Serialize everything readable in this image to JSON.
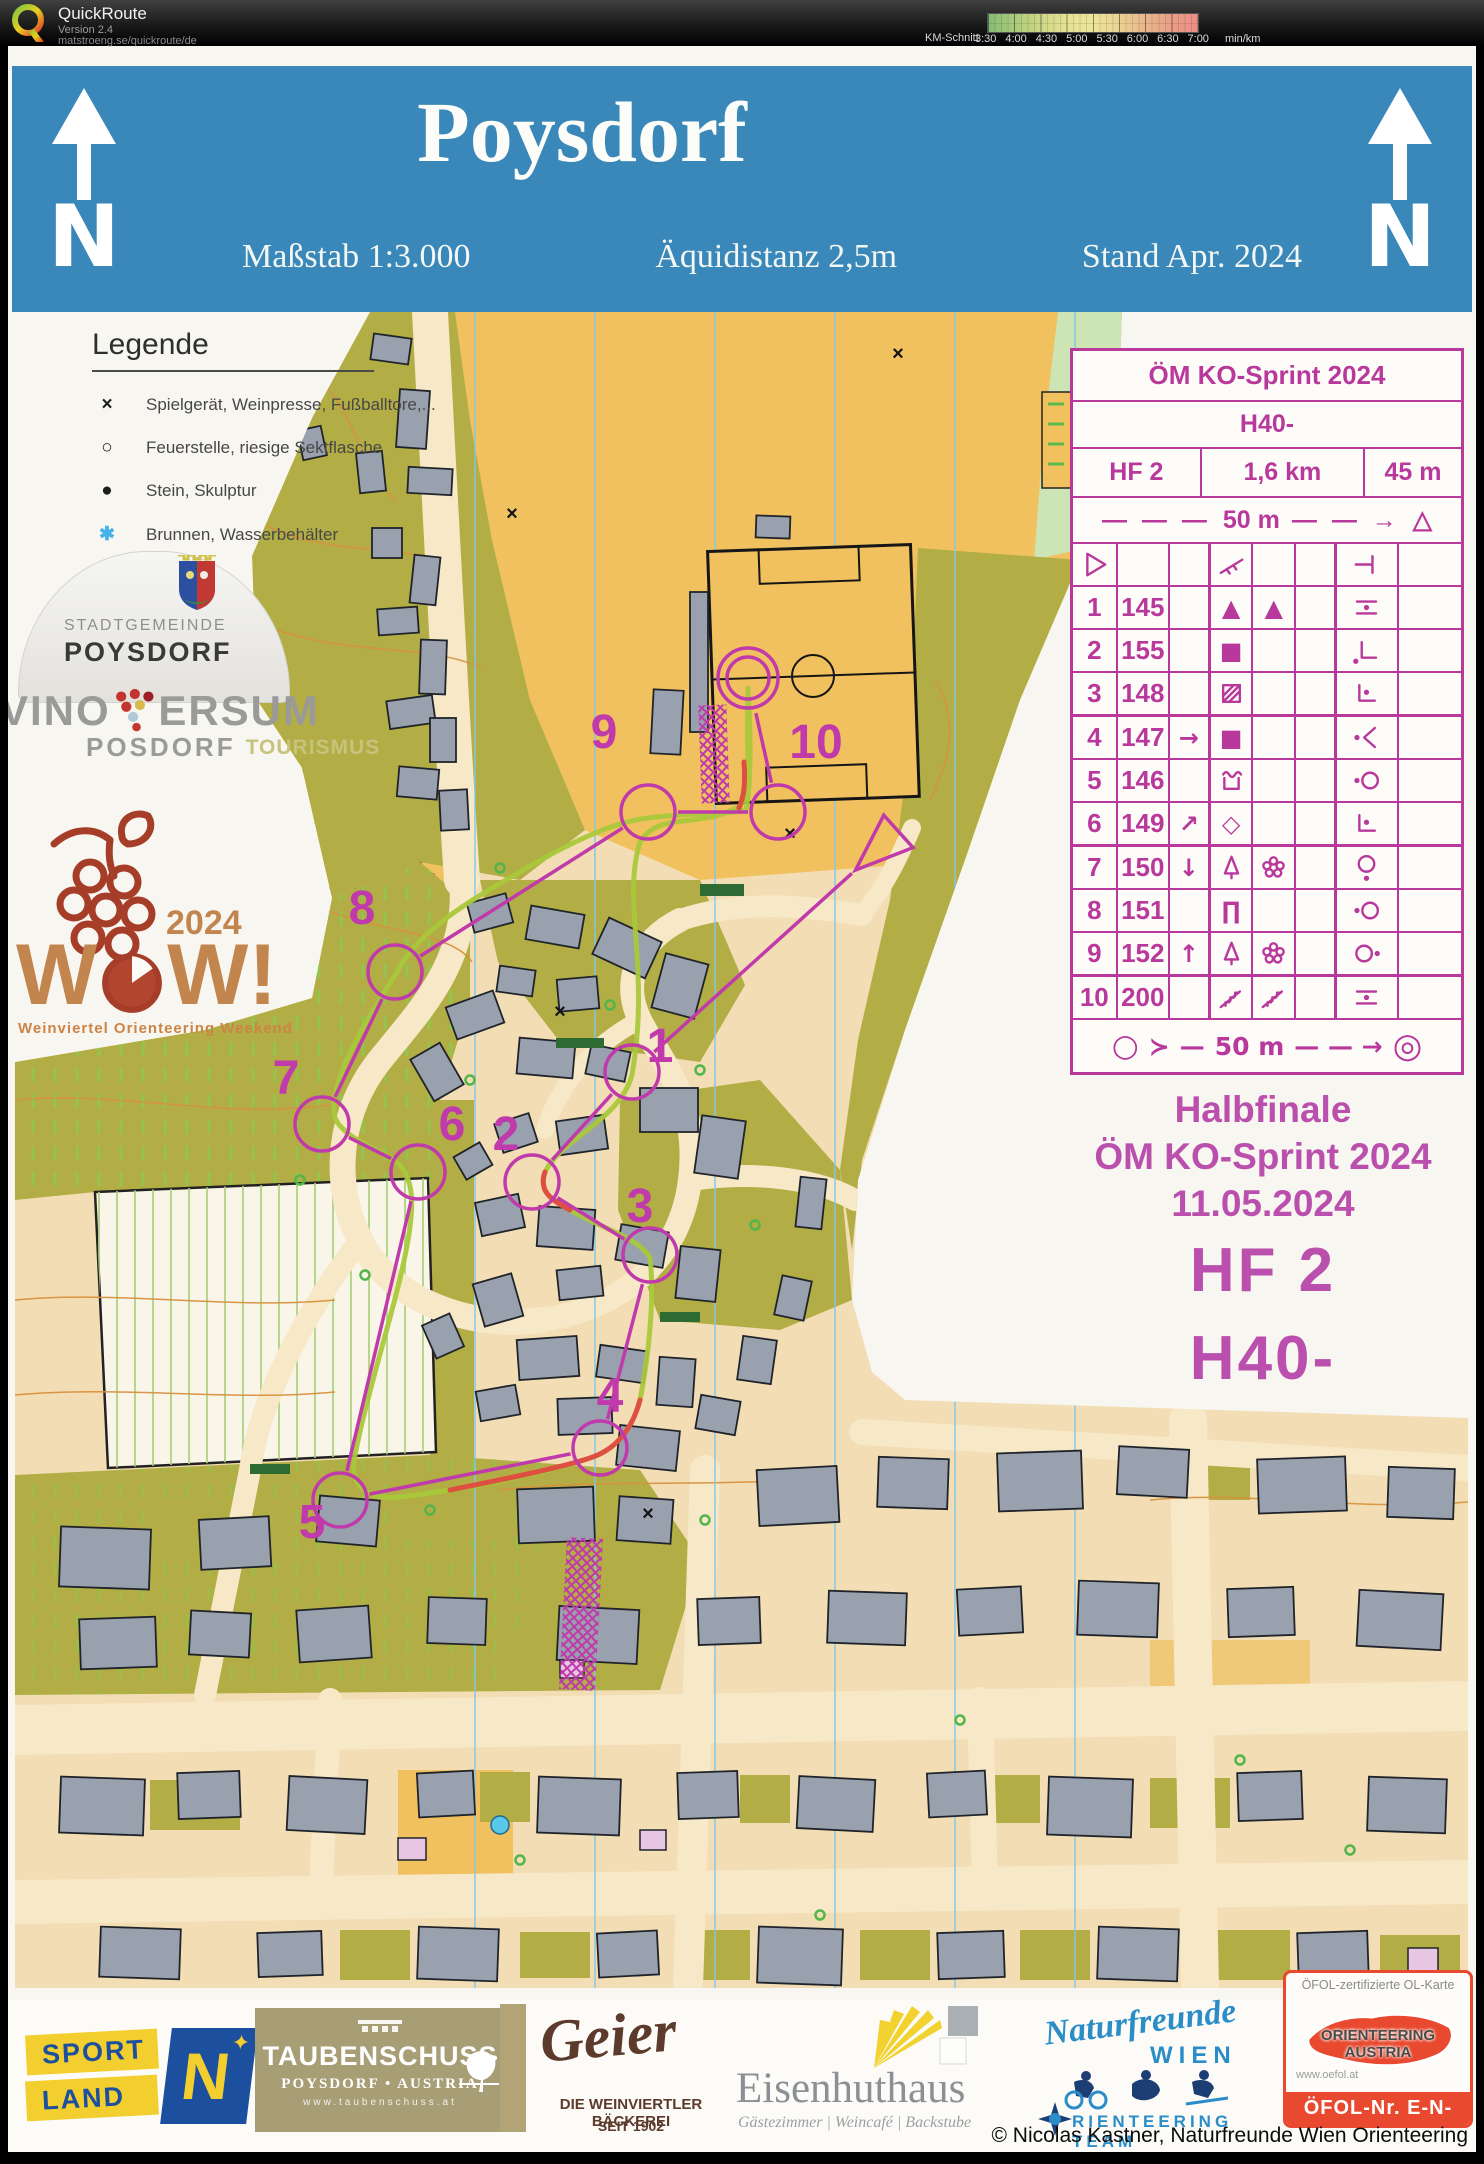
{
  "app": {
    "name": "QuickRoute",
    "version": "Version 2.4",
    "url": "matstroeng.se/quickroute/de"
  },
  "pace_scale": {
    "label": "KM-Schnitt",
    "unit": "min/km",
    "ticks": [
      "3:30",
      "4:00",
      "4:30",
      "5:00",
      "5:30",
      "6:00",
      "6:30",
      "7:00"
    ]
  },
  "map_header": {
    "title": "Poysdorf",
    "scale": "Maßstab 1:3.000",
    "equidistance": "Äquidistanz 2,5m",
    "status": "Stand Apr. 2024"
  },
  "legend": {
    "title": "Legende",
    "items": [
      {
        "glyph": "×",
        "color": "#1e1e1e",
        "label": "Spielgerät, Weinpresse, Fußballtore,..."
      },
      {
        "glyph": "○",
        "color": "#1e1e1e",
        "label": "Feuerstelle, riesige Sektflasche"
      },
      {
        "glyph": "●",
        "color": "#1e1e1e",
        "label": "Stein, Skulptur"
      },
      {
        "glyph": "✱",
        "color": "#45b1e8",
        "label": "Brunnen, Wasserbehälter"
      }
    ]
  },
  "logos": {
    "stadtgemeinde": {
      "line1": "STADTGEMEINDE",
      "line2": "POYSDORF"
    },
    "vinoversum": {
      "word1": "VINO",
      "word2": "ERSUM",
      "word3": "PO",
      "word4": "SDORF",
      "word5": "TOURISMUS"
    },
    "wow": {
      "year": "2024",
      "w1": "W",
      "w2": "W",
      "excl": "!",
      "subtitle": "Weinviertel  Orienteering  Weekend"
    }
  },
  "control_card": {
    "title": "ÖM KO-Sprint 2024",
    "class": "H40-",
    "heat": "HF  2",
    "length": "1,6 km",
    "climb": "45 m",
    "dist_start": {
      "left": "— — —",
      "label": "50 m",
      "right": "— — →",
      "tri": "△"
    },
    "dist_finish": {
      "c1": "○",
      "c2": "≻",
      "d": "—",
      "label": "50 m",
      "right": "— — →",
      "fin": "◎"
    },
    "rows": [
      {
        "cells": [
          "s:start",
          "",
          "",
          "s:slope",
          "",
          "",
          "s:spur",
          ""
        ]
      },
      {
        "cells": [
          "t:1",
          "t:145",
          "",
          "u:▲",
          "u:▲",
          "",
          "s:between",
          ""
        ]
      },
      {
        "cells": [
          "t:2",
          "t:155",
          "",
          "u:■",
          "",
          "",
          "s:corner-sw",
          ""
        ]
      },
      {
        "cells": [
          "t:3",
          "t:148",
          "",
          "s:square-hatch",
          "",
          "",
          "s:corner-dot",
          ""
        ]
      },
      {
        "cells": [
          "t:4",
          "t:147",
          "u:→",
          "u:■",
          "",
          "",
          "s:dot-angle",
          ""
        ]
      },
      {
        "cells": [
          "t:5",
          "t:146",
          "",
          "s:ruin",
          "",
          "",
          "s:dot-circle",
          ""
        ]
      },
      {
        "cells": [
          "t:6",
          "t:149",
          "u:↗",
          "u:◇",
          "",
          "",
          "s:corner-dot",
          ""
        ]
      },
      {
        "cells": [
          "t:7",
          "t:150",
          "u:↓",
          "s:tree",
          "s:flower",
          "",
          "s:circle-dot-bottom",
          ""
        ]
      },
      {
        "cells": [
          "t:8",
          "t:151",
          "",
          "u:∏",
          "",
          "",
          "s:dot-circle",
          ""
        ]
      },
      {
        "cells": [
          "t:9",
          "t:152",
          "u:↑",
          "s:tree",
          "s:flower",
          "",
          "s:circle-dot-right",
          ""
        ]
      },
      {
        "cells": [
          "t:10",
          "t:200",
          "",
          "s:stairs",
          "s:stairs",
          "",
          "s:between",
          ""
        ]
      }
    ]
  },
  "event_panel": {
    "line1": "Halbfinale",
    "line2": "ÖM KO-Sprint 2024",
    "line3": "11.05.2024",
    "heat": "HF  2",
    "class": "H40-"
  },
  "course": {
    "color": "#c03aab",
    "start": {
      "x": 880,
      "y": 848
    },
    "finish": {
      "x": 748,
      "y": 678
    },
    "controls": [
      {
        "n": "1",
        "x": 632,
        "y": 1072,
        "lx": 660,
        "ly": 1062
      },
      {
        "n": "2",
        "x": 532,
        "y": 1182,
        "lx": 506,
        "ly": 1150
      },
      {
        "n": "3",
        "x": 650,
        "y": 1255,
        "lx": 640,
        "ly": 1222
      },
      {
        "n": "4",
        "x": 600,
        "y": 1448,
        "lx": 610,
        "ly": 1412
      },
      {
        "n": "5",
        "x": 340,
        "y": 1500,
        "lx": 312,
        "ly": 1538
      },
      {
        "n": "6",
        "x": 418,
        "y": 1172,
        "lx": 452,
        "ly": 1140
      },
      {
        "n": "7",
        "x": 322,
        "y": 1124,
        "lx": 286,
        "ly": 1094
      },
      {
        "n": "8",
        "x": 395,
        "y": 972,
        "lx": 362,
        "ly": 924
      },
      {
        "n": "9",
        "x": 648,
        "y": 812,
        "lx": 604,
        "ly": 748
      },
      {
        "n": "10",
        "x": 778,
        "y": 812,
        "lx": 816,
        "ly": 758
      }
    ]
  },
  "sponsors": {
    "sportland": {
      "line1": "SPORT",
      "line2": "LAND",
      "n": "N",
      "star": "✦"
    },
    "taubenschuss": {
      "name": "TAUBENSCHUSS",
      "sub": "POYSDORF  •  AUSTRIA",
      "url": "www.taubenschuss.at"
    },
    "geier": {
      "name": "Geier",
      "sub1": "DIE WEINVIERTLER BÄCKEREI",
      "sub2": "SEIT 1902"
    },
    "eisenhuthaus": {
      "name": "Eisenhuthaus",
      "sub": "Gästezimmer  |  Weincafé  |  Backstube"
    },
    "naturfreunde": {
      "script": "Naturfreunde",
      "wien": "WIEN",
      "team": "RIENTEERING TEAM"
    },
    "oefol": {
      "top": "ÖFOL-zertifizierte OL-Karte",
      "mid": "ORIENTEERING AUSTRIA",
      "url": "www.oefol.at",
      "bottom": "ÖFOL-Nr. E-N-1865"
    }
  },
  "copyright": "© Nicolas Kastner, Naturfreunde Wien Orienteering"
}
